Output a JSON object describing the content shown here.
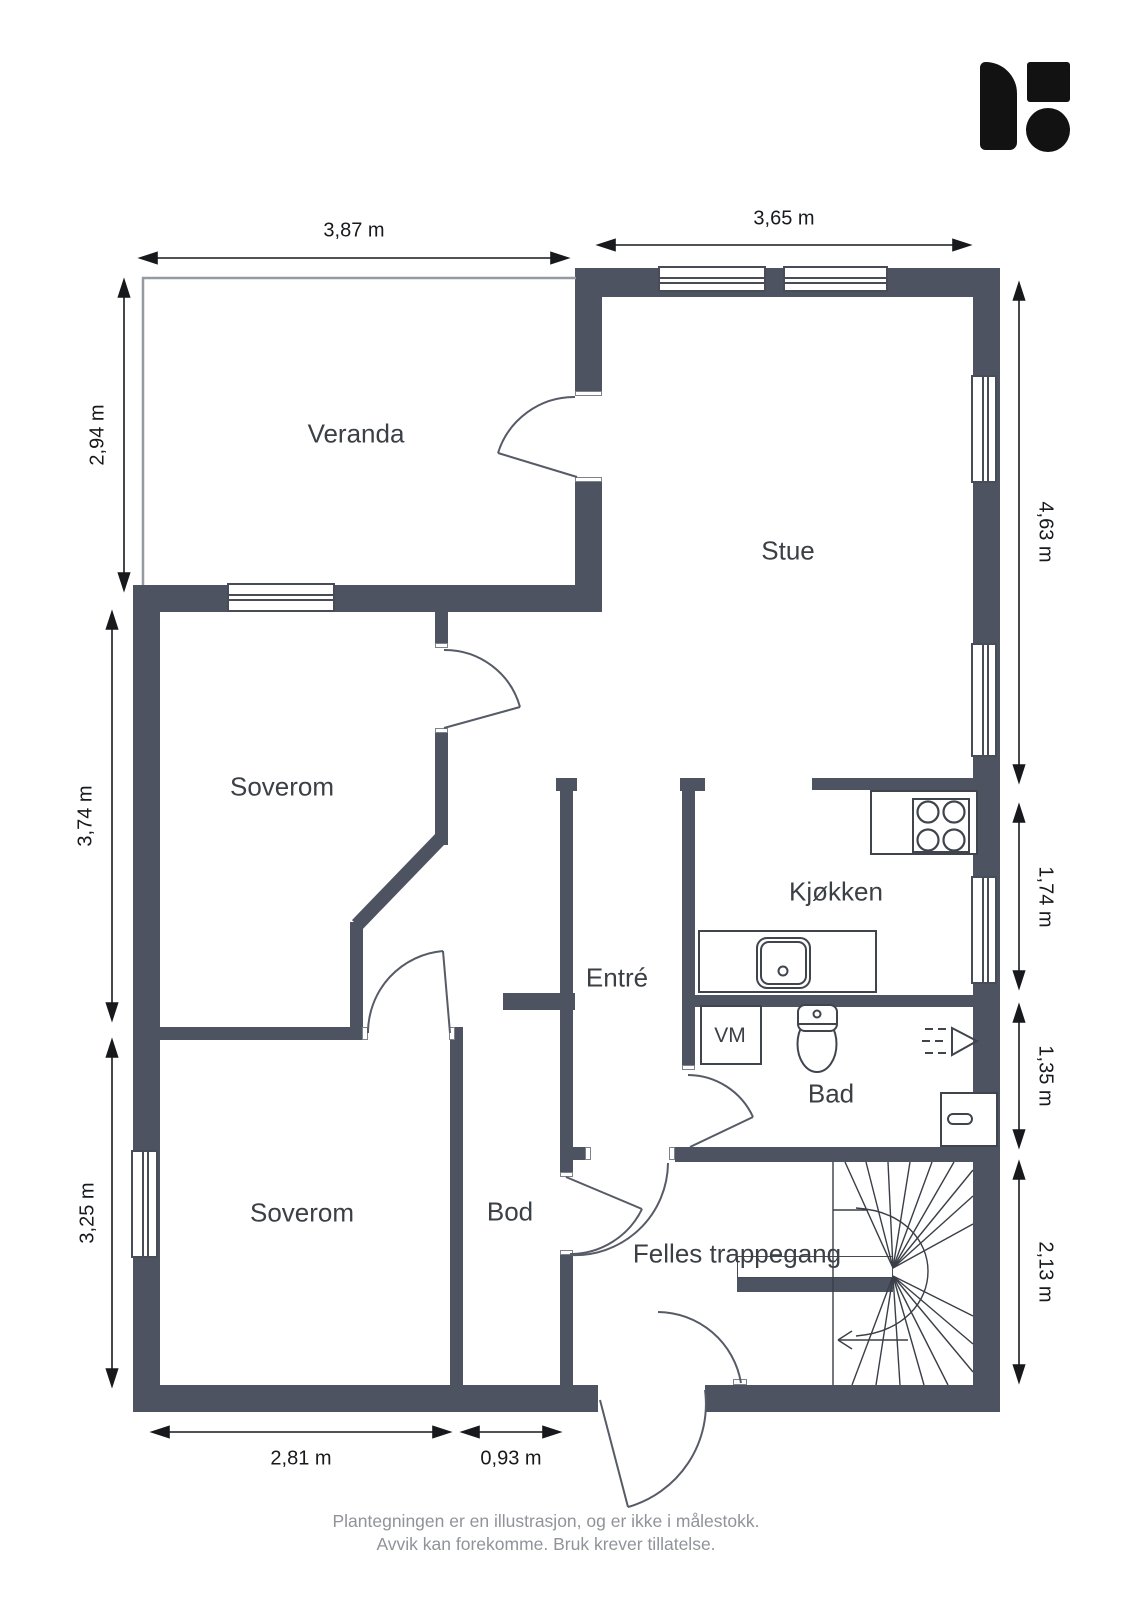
{
  "theme": {
    "wall_color": "#4d5360",
    "logo_color": "#121212",
    "dimension_text_color": "#17191c",
    "room_text_color": "#3b4046",
    "footer_text_color": "#909399"
  },
  "rooms": [
    {
      "label": "Veranda"
    },
    {
      "label": "Stue"
    },
    {
      "label": "Soverom"
    },
    {
      "label": "Kjøkken"
    },
    {
      "label": "Entré"
    },
    {
      "label": "Bad"
    },
    {
      "label": "Soverom"
    },
    {
      "label": "Bod"
    },
    {
      "label": "Felles trappegang"
    }
  ],
  "appliances": {
    "washing_machine": "VM"
  },
  "dimensions": {
    "veranda_width": "3,87 m",
    "stue_width": "3,65 m",
    "veranda_height": "2,94 m",
    "soverom_upper_height": "3,74 m",
    "soverom_lower_height": "3,25 m",
    "stue_height": "4,63 m",
    "kjokken_height": "1,74 m",
    "bad_height": "1,35 m",
    "trappegang_height": "2,13 m",
    "soverom_lower_width": "2,81 m",
    "bod_width": "0,93 m"
  },
  "footer": {
    "line1": "Plantegningen er en illustrasjon, og er ikke i målestokk.",
    "line2": "Avvik kan forekomme. Bruk krever tillatelse."
  },
  "icons": {
    "logo": "brand-logo",
    "stove": "stove-icon",
    "sink": "sink-icon",
    "toilet": "toilet-icon",
    "shower": "shower-icon",
    "stairs": "spiral-staircase"
  }
}
